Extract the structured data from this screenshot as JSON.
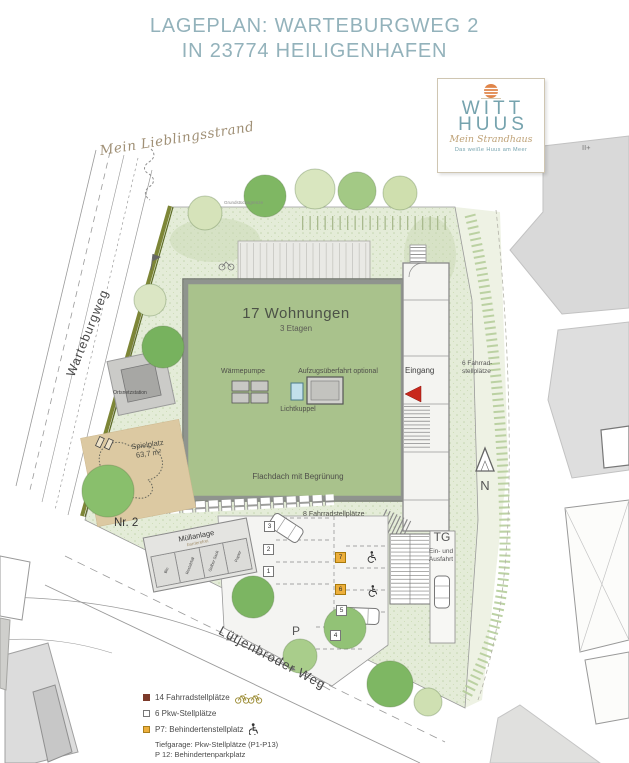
{
  "title": {
    "line1": "LAGEPLAN: WARTEBURGWEG 2",
    "line2": "IN 23774 HEILIGENHAFEN"
  },
  "logo": {
    "brand_line1": "WITT",
    "brand_line2": "HUUS",
    "script_line": "Mein Strandhaus",
    "tagline": "Das weiße Huus am Meer"
  },
  "plan": {
    "handwritten_note": "Mein Lieblingsstrand",
    "streets": {
      "left": "Warteburgweg",
      "bottom": "Lütjenbroder Weg"
    },
    "boundary_label": "Grundstücksgrenze",
    "neighbor_storeys": "II+",
    "building": {
      "headline": "17 Wohnungen",
      "storeys": "3 Etagen",
      "heat_pump": "Wärmepumpe",
      "elevator": "Aufzugsüberfahrt optional",
      "skylight": "Lichtkuppel",
      "roof": "Flachdach mit Begrünung",
      "entrance": "Eingang"
    },
    "bike_right_line1": "6 Fahrrad-",
    "bike_right_line2": "stellplätze",
    "bike_bottom": "8 Fahrradstellplätze",
    "compass": "N",
    "playground": {
      "label": "Spielplatz",
      "area": "63,7 m²"
    },
    "station": "Ortsnetzstation",
    "house_no": "Nr. 2",
    "waste": {
      "label": "Müllanlage",
      "sublabel": "barrierefrei",
      "bins": [
        "Bio",
        "Restabfall",
        "Gelber Sack",
        "Papier"
      ]
    },
    "garage": {
      "label": "TG",
      "line1": "Ein- und",
      "line2": "Ausfahrt"
    },
    "parking_letter": "P",
    "parking_numbers": [
      "1",
      "2",
      "3",
      "4",
      "5",
      "6",
      "7"
    ]
  },
  "legend": {
    "items": [
      {
        "label": "14 Fahrradstellplätze"
      },
      {
        "label": "6 Pkw-Stellplätze"
      },
      {
        "label": "P7: Behindertenstellplatz"
      }
    ],
    "footnote_line1": "Tiefgarage: Pkw-Stellplätze (P1-P13)",
    "footnote_line2": "P 12: Behindertenparkplatz"
  },
  "colors": {
    "title_teal": "#93B2BB",
    "logo_teal": "#76A3AE",
    "sun_orange": "#E08448",
    "roof_green": "#A9C28C",
    "lawn_green": "#E4ECD8",
    "tree_dark": "#7BB25F",
    "tree_pale": "#D3E2B6",
    "playground_tan": "#DCC9A2",
    "hedge_olive": "#7D8637",
    "accent_orange": "#EDAF3C",
    "arrow_red": "#C8281C",
    "legend_darkred": "#7C3A2A"
  }
}
